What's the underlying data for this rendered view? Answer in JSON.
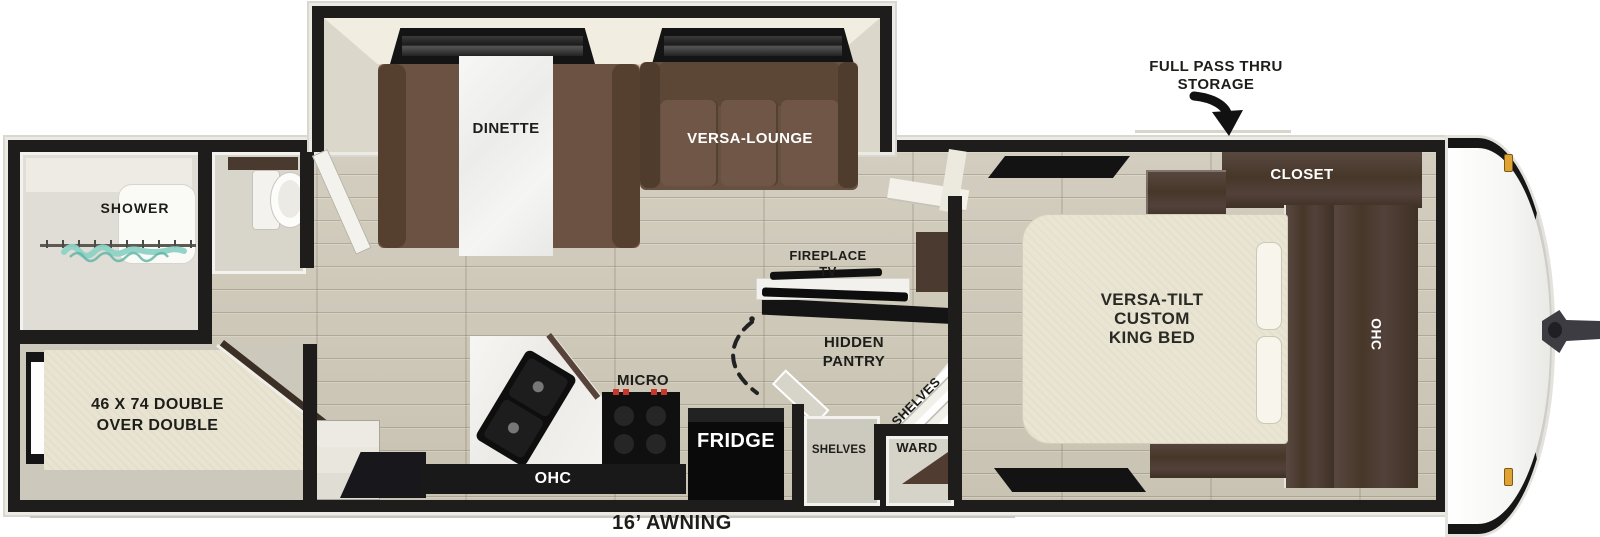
{
  "labels": {
    "shower": "SHOWER",
    "bunk_bed": "46 X 74 DOUBLE\nOVER DOUBLE",
    "dinette": "DINETTE",
    "versa_lounge": "VERSA-LOUNGE",
    "fireplace_tv": "FIREPLACE\nTV",
    "hidden_pantry": "HIDDEN\nPANTRY",
    "pantry_corner_shelves": "SHELVES",
    "entry_shelves": "SHELVES",
    "wardrobe": "WARD",
    "microwave": "MICRO",
    "fridge": "FRIDGE",
    "kitchen_ohc": "OHC",
    "closet": "CLOSET",
    "bedroom_ohc": "OHC",
    "king_bed": "VERSA-TILT\nCUSTOM\nKING BED",
    "storage_callout": "FULL PASS THRU\nSTORAGE",
    "awning": "16’ AWNING"
  },
  "colors": {
    "wall_black": "#1e1d1b",
    "floor_wood": "#cdc7b8",
    "sofa_brown": "#6b5243",
    "cabinet_wood": "#4a3a30",
    "bed_cream": "#e9e4d2",
    "counter_white": "#f4f3f0",
    "appliance_black": "#111111",
    "shower_curtain_teal": "#8ed2c5",
    "burner_red": "#c9372c",
    "marker_amber": "#e0a233"
  }
}
